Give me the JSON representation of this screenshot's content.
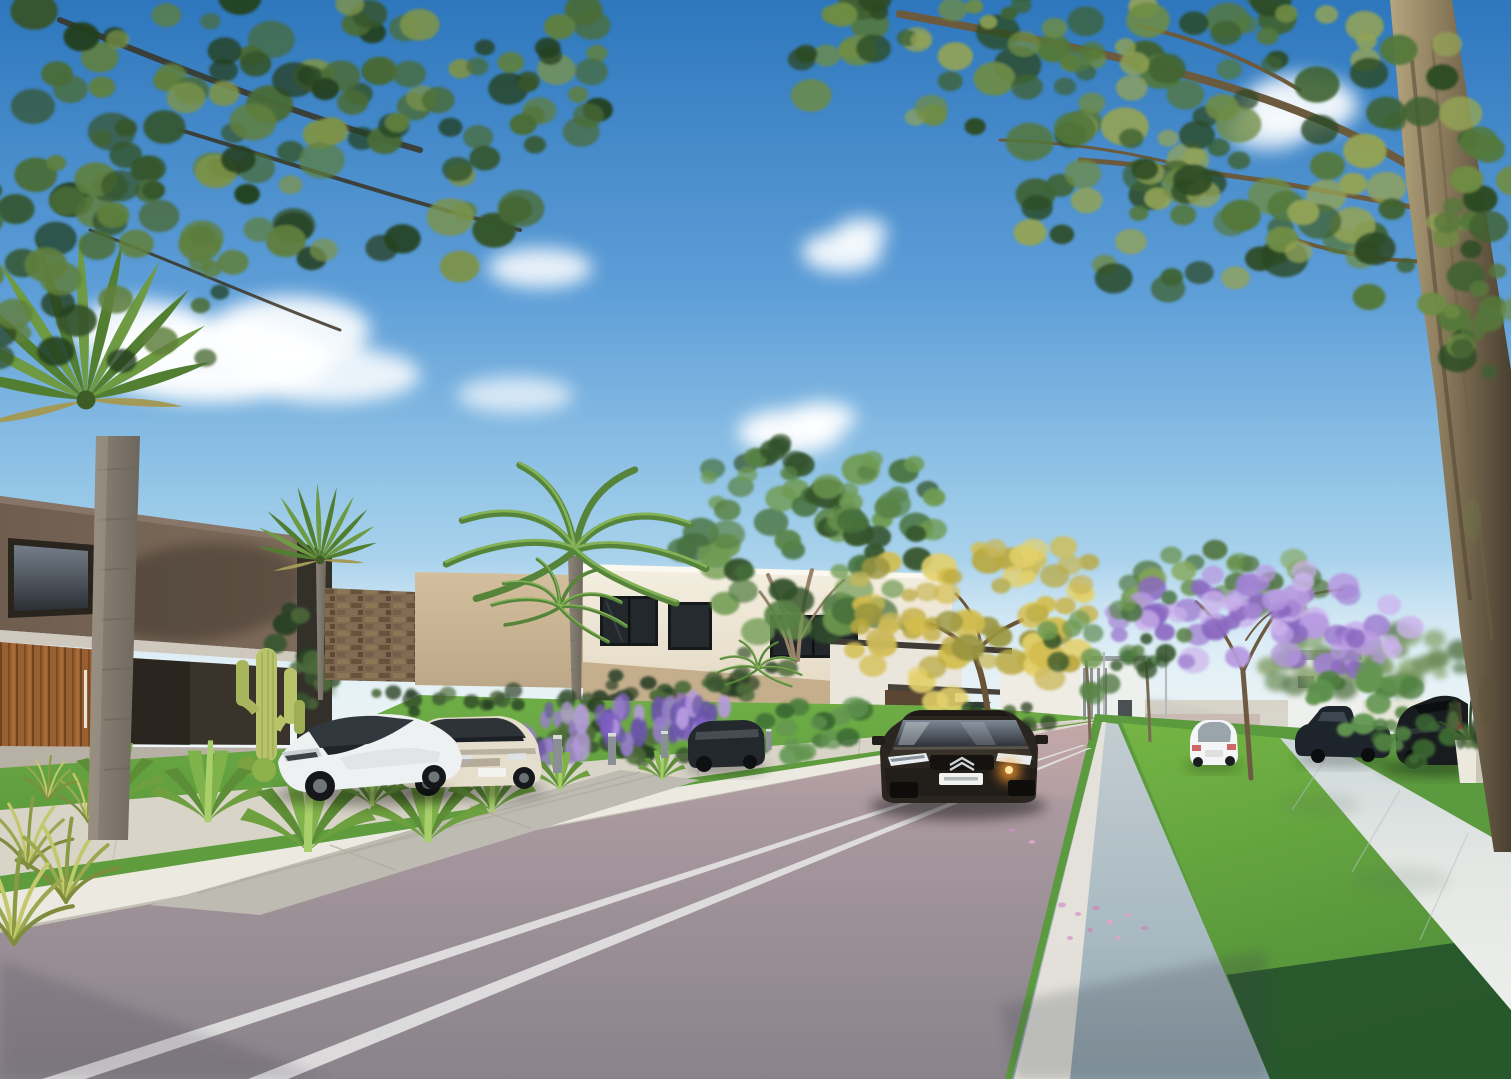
{
  "meta": {
    "title": "residential-street-architectural-render",
    "width": 1511,
    "height": 1079
  },
  "palette": {
    "sky_top": "#2e77bd",
    "sky_mid": "#5f9fd8",
    "sky_low": "#9ccbe9",
    "sky_horizon": "#eaf5f9",
    "cloud": "#ffffff",
    "haze": "#e9f3f6",
    "hill": "#a9bcc6",
    "hill_far": "#c4d4da",
    "road_far": "#c2a9a9",
    "road_mid": "#9c9097",
    "road_near": "#8a838b",
    "marking": "#e3e2e2",
    "curb_left": "#ece9e0",
    "gutter_light": "#c3cdd2",
    "gutter_dark": "#8fa2ac",
    "gutter_line": "#e6e3da",
    "sidewalk_left": "#d9d4c8",
    "sidewalk_right": "#e3e7e4",
    "sidewalk_right_low": "#cdd8d9",
    "grass_left": "#5e9c3e",
    "grass_left_light": "#6fae46",
    "grass_median": "#74b544",
    "grass_median_low": "#4e8c38",
    "grass_shadow": "#22512a",
    "grass_right": "#5c9a3f",
    "garden_hedge": "#33602f",
    "house_dark_wall": "#6f5e50",
    "house_dark_wall2": "#7d6a59",
    "house_dark_deep": "#3a332c",
    "soffit": "#cfc8bc",
    "plinth": "#b7b0a4",
    "wood_door": "#9a5f30",
    "wood_door_dark": "#6e431f",
    "stone_wall": "#8a7158",
    "beige_wall": "#d3bf9d",
    "beige_wall_low": "#bca888",
    "cream_wall": "#f4efe1",
    "cream_wall_low": "#e3d8c2",
    "window_glass": "#23282c",
    "window_frame": "#16191c",
    "center_house_white": "#eae6dc",
    "wood_dark": "#5a4633",
    "umbrella": "#3c4144",
    "bg_building": "#eef0ee",
    "bg_building_fin": "#8e959a",
    "trunk_big": "#8a7a5c",
    "trunk_big_dark": "#4a4030",
    "trunk_big_light": "#b5a67e",
    "palm_trunk": "#8d857a",
    "palm_trunk_dark": "#6e675c",
    "branch": "#6b5a3e",
    "cactus": "#b9c46a",
    "cactus_dark": "#8fa04f",
    "car_white": "#eef1f2",
    "car_cream": "#e6decd",
    "car_dark": "#2b2520",
    "car_dark_hi": "#57524a",
    "suv_dark": "#181c1f",
    "pickup_dark": "#1e242c",
    "minivan_dark": "#23282c",
    "headlight_glow": "#ff9d2e",
    "chrome": "#cfd4d8",
    "plate": "#f2f3ee",
    "planter": "#ebe8dc",
    "bollard": "#8a8f93",
    "petal": "#d9a7c9",
    "pole": "#b8bcbd"
  },
  "inventory": [
    "blue sky with scattered white clouds",
    "overhanging tree canopy top-left and large tree with trunk on right edge",
    "modern dark-brown two-story house with wood slat door and cactus garden",
    "stone feature wall and beige privacy wall",
    "cream two-story house with dark framed windows and palm trees",
    "golden flowering tree and purple jacaranda tree",
    "asphalt street with double white center lines",
    "white curb, grass verges, concrete sidewalks and driveway",
    "parked white coupe, cream sedan, dark minivan, dark pickup and dark SUV",
    "dark sedan driving toward viewer with lit headlight",
    "white sedan driving away in distance",
    "lavender bushes, agave plants, tall grass tufts and white planter pot",
    "street light poles and path bollards"
  ],
  "foliage": [
    {
      "slot": 0,
      "cx": 1352,
      "cy": 662,
      "rx": 92,
      "ry": 38,
      "n": 24,
      "rmin": 8,
      "rmax": 16,
      "aspect": 0.8,
      "seed": 11,
      "op": 0.9,
      "colors": [
        "#5a7a4e",
        "#6f8e5a",
        "#83a066"
      ]
    },
    {
      "slot": 1,
      "cx": 1434,
      "cy": 654,
      "rx": 60,
      "ry": 30,
      "n": 16,
      "rmin": 7,
      "rmax": 14,
      "aspect": 0.8,
      "seed": 12,
      "op": 0.9,
      "colors": [
        "#5a7a4e",
        "#6f8e5a",
        "#83a066"
      ]
    },
    {
      "slot": 2,
      "cx": 646,
      "cy": 690,
      "rx": 62,
      "ry": 20,
      "n": 14,
      "rmin": 6,
      "rmax": 12,
      "aspect": 0.8,
      "seed": 13,
      "op": 0.95,
      "colors": [
        "#283f24",
        "#3a5530",
        "#4c6a3a"
      ]
    },
    {
      "slot": 3,
      "cx": 748,
      "cy": 674,
      "rx": 55,
      "ry": 24,
      "n": 14,
      "rmin": 6,
      "rmax": 12,
      "aspect": 0.8,
      "seed": 14,
      "op": 0.95,
      "colors": [
        "#283f24",
        "#3a5530",
        "#4c6a3a"
      ]
    },
    {
      "slot": 4,
      "cx": 312,
      "cy": 648,
      "rx": 42,
      "ry": 46,
      "n": 16,
      "rmin": 7,
      "rmax": 14,
      "aspect": 0.85,
      "seed": 15,
      "op": 1,
      "colors": [
        "#283f24",
        "#3a5530",
        "#4c6a3a"
      ]
    },
    {
      "slot": 5,
      "cx": 802,
      "cy": 548,
      "rx": 120,
      "ry": 92,
      "n": 48,
      "rmin": 9,
      "rmax": 20,
      "aspect": 0.8,
      "seed": 16,
      "op": 0.95,
      "colors": [
        "#33522a",
        "#45703a",
        "#588245",
        "#6f9a50"
      ]
    },
    {
      "slot": 6,
      "cx": 758,
      "cy": 480,
      "rx": 62,
      "ry": 42,
      "n": 16,
      "rmin": 8,
      "rmax": 16,
      "aspect": 0.8,
      "seed": 17,
      "op": 0.95,
      "colors": [
        "#33522a",
        "#45703a",
        "#588245",
        "#6f9a50"
      ]
    },
    {
      "slot": 7,
      "cx": 874,
      "cy": 504,
      "rx": 72,
      "ry": 50,
      "n": 20,
      "rmin": 8,
      "rmax": 16,
      "aspect": 0.8,
      "seed": 18,
      "op": 0.95,
      "colors": [
        "#33522a",
        "#45703a",
        "#588245",
        "#6f9a50"
      ]
    },
    {
      "slot": 8,
      "cx": 966,
      "cy": 624,
      "rx": 124,
      "ry": 80,
      "n": 44,
      "rmin": 9,
      "rmax": 18,
      "aspect": 0.8,
      "seed": 19,
      "op": 0.95,
      "colors": [
        "#b9a83f",
        "#d3bd4e",
        "#e3d06a",
        "#9a953f",
        "#c9b75a"
      ]
    },
    {
      "slot": 9,
      "cx": 1034,
      "cy": 590,
      "rx": 70,
      "ry": 48,
      "n": 18,
      "rmin": 8,
      "rmax": 15,
      "aspect": 0.8,
      "seed": 20,
      "op": 0.95,
      "colors": [
        "#b9a83f",
        "#d3bd4e",
        "#e3d06a",
        "#c9b75a"
      ]
    },
    {
      "slot": 10,
      "cx": 903,
      "cy": 602,
      "rx": 62,
      "ry": 44,
      "n": 16,
      "rmin": 8,
      "rmax": 15,
      "aspect": 0.8,
      "seed": 21,
      "op": 0.95,
      "colors": [
        "#b9a83f",
        "#d3bd4e",
        "#9a953f",
        "#c9b75a"
      ]
    },
    {
      "slot": 11,
      "cx": 1234,
      "cy": 578,
      "rx": 112,
      "ry": 46,
      "n": 26,
      "rmin": 8,
      "rmax": 16,
      "aspect": 0.8,
      "seed": 22,
      "op": 0.9,
      "colors": [
        "#4d7038",
        "#68904a",
        "#86a85c"
      ]
    },
    {
      "slot": 12,
      "cx": 1182,
      "cy": 628,
      "rx": 74,
      "ry": 46,
      "n": 26,
      "rmin": 8,
      "rmax": 16,
      "aspect": 0.85,
      "seed": 23,
      "op": 0.95,
      "colors": [
        "#8a68c0",
        "#a182d2",
        "#b79ae0",
        "#cbb2ec"
      ]
    },
    {
      "slot": 13,
      "cx": 1334,
      "cy": 617,
      "rx": 78,
      "ry": 50,
      "n": 26,
      "rmin": 8,
      "rmax": 16,
      "aspect": 0.85,
      "seed": 24,
      "op": 0.95,
      "colors": [
        "#8a68c0",
        "#a182d2",
        "#b79ae0",
        "#cbb2ec"
      ]
    },
    {
      "slot": 14,
      "cx": 1259,
      "cy": 594,
      "rx": 62,
      "ry": 36,
      "n": 18,
      "rmin": 7,
      "rmax": 14,
      "aspect": 0.85,
      "seed": 25,
      "op": 0.95,
      "colors": [
        "#8a68c0",
        "#a182d2",
        "#b79ae0",
        "#cbb2ec"
      ]
    },
    {
      "slot": 15,
      "cx": 1092,
      "cy": 644,
      "rx": 46,
      "ry": 56,
      "n": 14,
      "rmin": 6,
      "rmax": 12,
      "aspect": 0.9,
      "seed": 26,
      "op": 0.9,
      "colors": [
        "#33522a",
        "#45703a",
        "#588245",
        "#6f9a50"
      ]
    },
    {
      "slot": 16,
      "cx": 1152,
      "cy": 634,
      "rx": 42,
      "ry": 52,
      "n": 12,
      "rmin": 6,
      "rmax": 12,
      "aspect": 0.9,
      "seed": 27,
      "op": 0.9,
      "colors": [
        "#33522a",
        "#45703a",
        "#588245",
        "#6f9a50"
      ]
    },
    {
      "slot": 17,
      "cx": 802,
      "cy": 724,
      "rx": 72,
      "ry": 32,
      "n": 20,
      "rmin": 7,
      "rmax": 14,
      "aspect": 0.8,
      "seed": 28,
      "op": 1,
      "colors": [
        "#3c6a32",
        "#4f8040",
        "#639651"
      ]
    },
    {
      "slot": 18,
      "cx": 612,
      "cy": 744,
      "rx": 112,
      "ry": 20,
      "n": 26,
      "rmin": 6,
      "rmax": 11,
      "aspect": 0.9,
      "seed": 29,
      "op": 1,
      "colors": [
        "#283f24",
        "#3a5530",
        "#4c6a3a"
      ]
    },
    {
      "slot": 19,
      "cx": 562,
      "cy": 734,
      "rx": 64,
      "ry": 26,
      "n": 24,
      "rmin": 4,
      "rmax": 9,
      "aspect": 1.8,
      "seed": 30,
      "op": 0.95,
      "colors": [
        "#7e5fc0",
        "#9b7fd0",
        "#b79ae0",
        "#6a55a8"
      ]
    },
    {
      "slot": 20,
      "cx": 648,
      "cy": 726,
      "rx": 58,
      "ry": 24,
      "n": 22,
      "rmin": 4,
      "rmax": 9,
      "aspect": 1.8,
      "seed": 31,
      "op": 0.95,
      "colors": [
        "#7e5fc0",
        "#9b7fd0",
        "#b79ae0",
        "#6a55a8"
      ]
    },
    {
      "slot": 21,
      "cx": 705,
      "cy": 720,
      "rx": 46,
      "ry": 20,
      "n": 18,
      "rmin": 4,
      "rmax": 8,
      "aspect": 1.8,
      "seed": 32,
      "op": 0.95,
      "colors": [
        "#7e5fc0",
        "#9b7fd0",
        "#b79ae0",
        "#6a55a8"
      ]
    },
    {
      "slot": 22,
      "cx": 1370,
      "cy": 702,
      "rx": 62,
      "ry": 34,
      "n": 18,
      "rmin": 7,
      "rmax": 14,
      "aspect": 0.85,
      "seed": 33,
      "op": 1,
      "colors": [
        "#3c6a32",
        "#4f8040",
        "#639651"
      ]
    },
    {
      "slot": 23,
      "cx": 1422,
      "cy": 740,
      "rx": 44,
      "ry": 26,
      "n": 12,
      "rmin": 6,
      "rmax": 12,
      "aspect": 0.85,
      "seed": 34,
      "op": 1,
      "colors": [
        "#3c6a32",
        "#4f8040",
        "#639651"
      ]
    },
    {
      "slot": 24,
      "cx": 1472,
      "cy": 724,
      "rx": 26,
      "ry": 20,
      "n": 10,
      "rmin": 4,
      "rmax": 9,
      "aspect": 1.6,
      "seed": 35,
      "op": 1,
      "colors": [
        "#283f24",
        "#3a5530",
        "#4c6a3a"
      ]
    },
    {
      "slot": 25,
      "cx": 122,
      "cy": 72,
      "rx": 268,
      "ry": 150,
      "n": 60,
      "rmin": 10,
      "rmax": 24,
      "aspect": 0.8,
      "seed": 36,
      "op": 0.98,
      "colors": [
        "#24401f",
        "#35552b",
        "#4a6b35",
        "#5f7f3d",
        "#7d934a"
      ]
    },
    {
      "slot": 26,
      "cx": 338,
      "cy": 152,
      "rx": 238,
      "ry": 136,
      "n": 52,
      "rmin": 10,
      "rmax": 24,
      "aspect": 0.8,
      "seed": 37,
      "op": 0.98,
      "colors": [
        "#24401f",
        "#35552b",
        "#4a6b35",
        "#5f7f3d",
        "#7d934a"
      ]
    },
    {
      "slot": 27,
      "cx": 88,
      "cy": 268,
      "rx": 188,
      "ry": 116,
      "n": 40,
      "rmin": 9,
      "rmax": 22,
      "aspect": 0.8,
      "seed": 38,
      "op": 0.98,
      "colors": [
        "#24401f",
        "#35552b",
        "#4a6b35",
        "#5f7f3d"
      ]
    },
    {
      "slot": 28,
      "cx": 468,
      "cy": 72,
      "rx": 168,
      "ry": 96,
      "n": 30,
      "rmin": 9,
      "rmax": 20,
      "aspect": 0.8,
      "seed": 39,
      "op": 0.98,
      "colors": [
        "#24401f",
        "#35552b",
        "#4a6b35",
        "#5f7f3d",
        "#7d934a"
      ]
    },
    {
      "slot": 29,
      "cx": 1062,
      "cy": 78,
      "rx": 268,
      "ry": 126,
      "n": 52,
      "rmin": 10,
      "rmax": 24,
      "aspect": 0.8,
      "seed": 40,
      "op": 0.98,
      "colors": [
        "#2c4a24",
        "#3f6231",
        "#54783a",
        "#6f8c44",
        "#93a355"
      ]
    },
    {
      "slot": 30,
      "cx": 1298,
      "cy": 128,
      "rx": 238,
      "ry": 136,
      "n": 52,
      "rmin": 10,
      "rmax": 24,
      "aspect": 0.8,
      "seed": 41,
      "op": 0.98,
      "colors": [
        "#2c4a24",
        "#3f6231",
        "#54783a",
        "#6f8c44",
        "#93a355"
      ]
    },
    {
      "slot": 31,
      "cx": 1168,
      "cy": 208,
      "rx": 158,
      "ry": 86,
      "n": 28,
      "rmin": 9,
      "rmax": 20,
      "aspect": 0.8,
      "seed": 42,
      "op": 0.98,
      "colors": [
        "#2c4a24",
        "#3f6231",
        "#54783a",
        "#6f8c44",
        "#93a355"
      ]
    },
    {
      "slot": 32,
      "cx": 1464,
      "cy": 248,
      "rx": 118,
      "ry": 118,
      "n": 26,
      "rmin": 9,
      "rmax": 20,
      "aspect": 0.8,
      "seed": 43,
      "op": 0.98,
      "colors": [
        "#2c4a24",
        "#3f6231",
        "#54783a",
        "#6f8c44"
      ]
    },
    {
      "slot": 33,
      "cx": 958,
      "cy": 48,
      "rx": 148,
      "ry": 76,
      "n": 20,
      "rmin": 8,
      "rmax": 18,
      "aspect": 0.8,
      "seed": 44,
      "op": 0.95,
      "colors": [
        "#2c4a24",
        "#3f6231",
        "#54783a",
        "#6f8c44",
        "#93a355"
      ]
    },
    {
      "slot": 34,
      "cx": 1502,
      "cy": 306,
      "rx": 56,
      "ry": 72,
      "n": 14,
      "rmin": 8,
      "rmax": 16,
      "aspect": 0.85,
      "seed": 45,
      "op": 0.95,
      "colors": [
        "#2c4a24",
        "#3f6231",
        "#54783a",
        "#6f8c44"
      ]
    },
    {
      "slot": 35,
      "cx": 1352,
      "cy": 650,
      "rx": 30,
      "ry": 20,
      "n": 10,
      "rmin": 5,
      "rmax": 10,
      "aspect": 1,
      "seed": 46,
      "op": 0.9,
      "colors": [
        "#8a68c0",
        "#a182d2",
        "#b79ae0"
      ]
    },
    {
      "slot": 36,
      "cx": 480,
      "cy": 702,
      "rx": 190,
      "ry": 14,
      "n": 22,
      "rmin": 5,
      "rmax": 10,
      "aspect": 0.9,
      "seed": 47,
      "op": 0.9,
      "colors": [
        "#283f24",
        "#3a5530",
        "#4c6a3a"
      ]
    },
    {
      "slot": 37,
      "cx": 1002,
      "cy": 716,
      "rx": 60,
      "ry": 14,
      "n": 12,
      "rmin": 5,
      "rmax": 9,
      "aspect": 0.9,
      "seed": 48,
      "op": 0.9,
      "colors": [
        "#283f24",
        "#3a5530",
        "#4c6a3a"
      ]
    }
  ]
}
